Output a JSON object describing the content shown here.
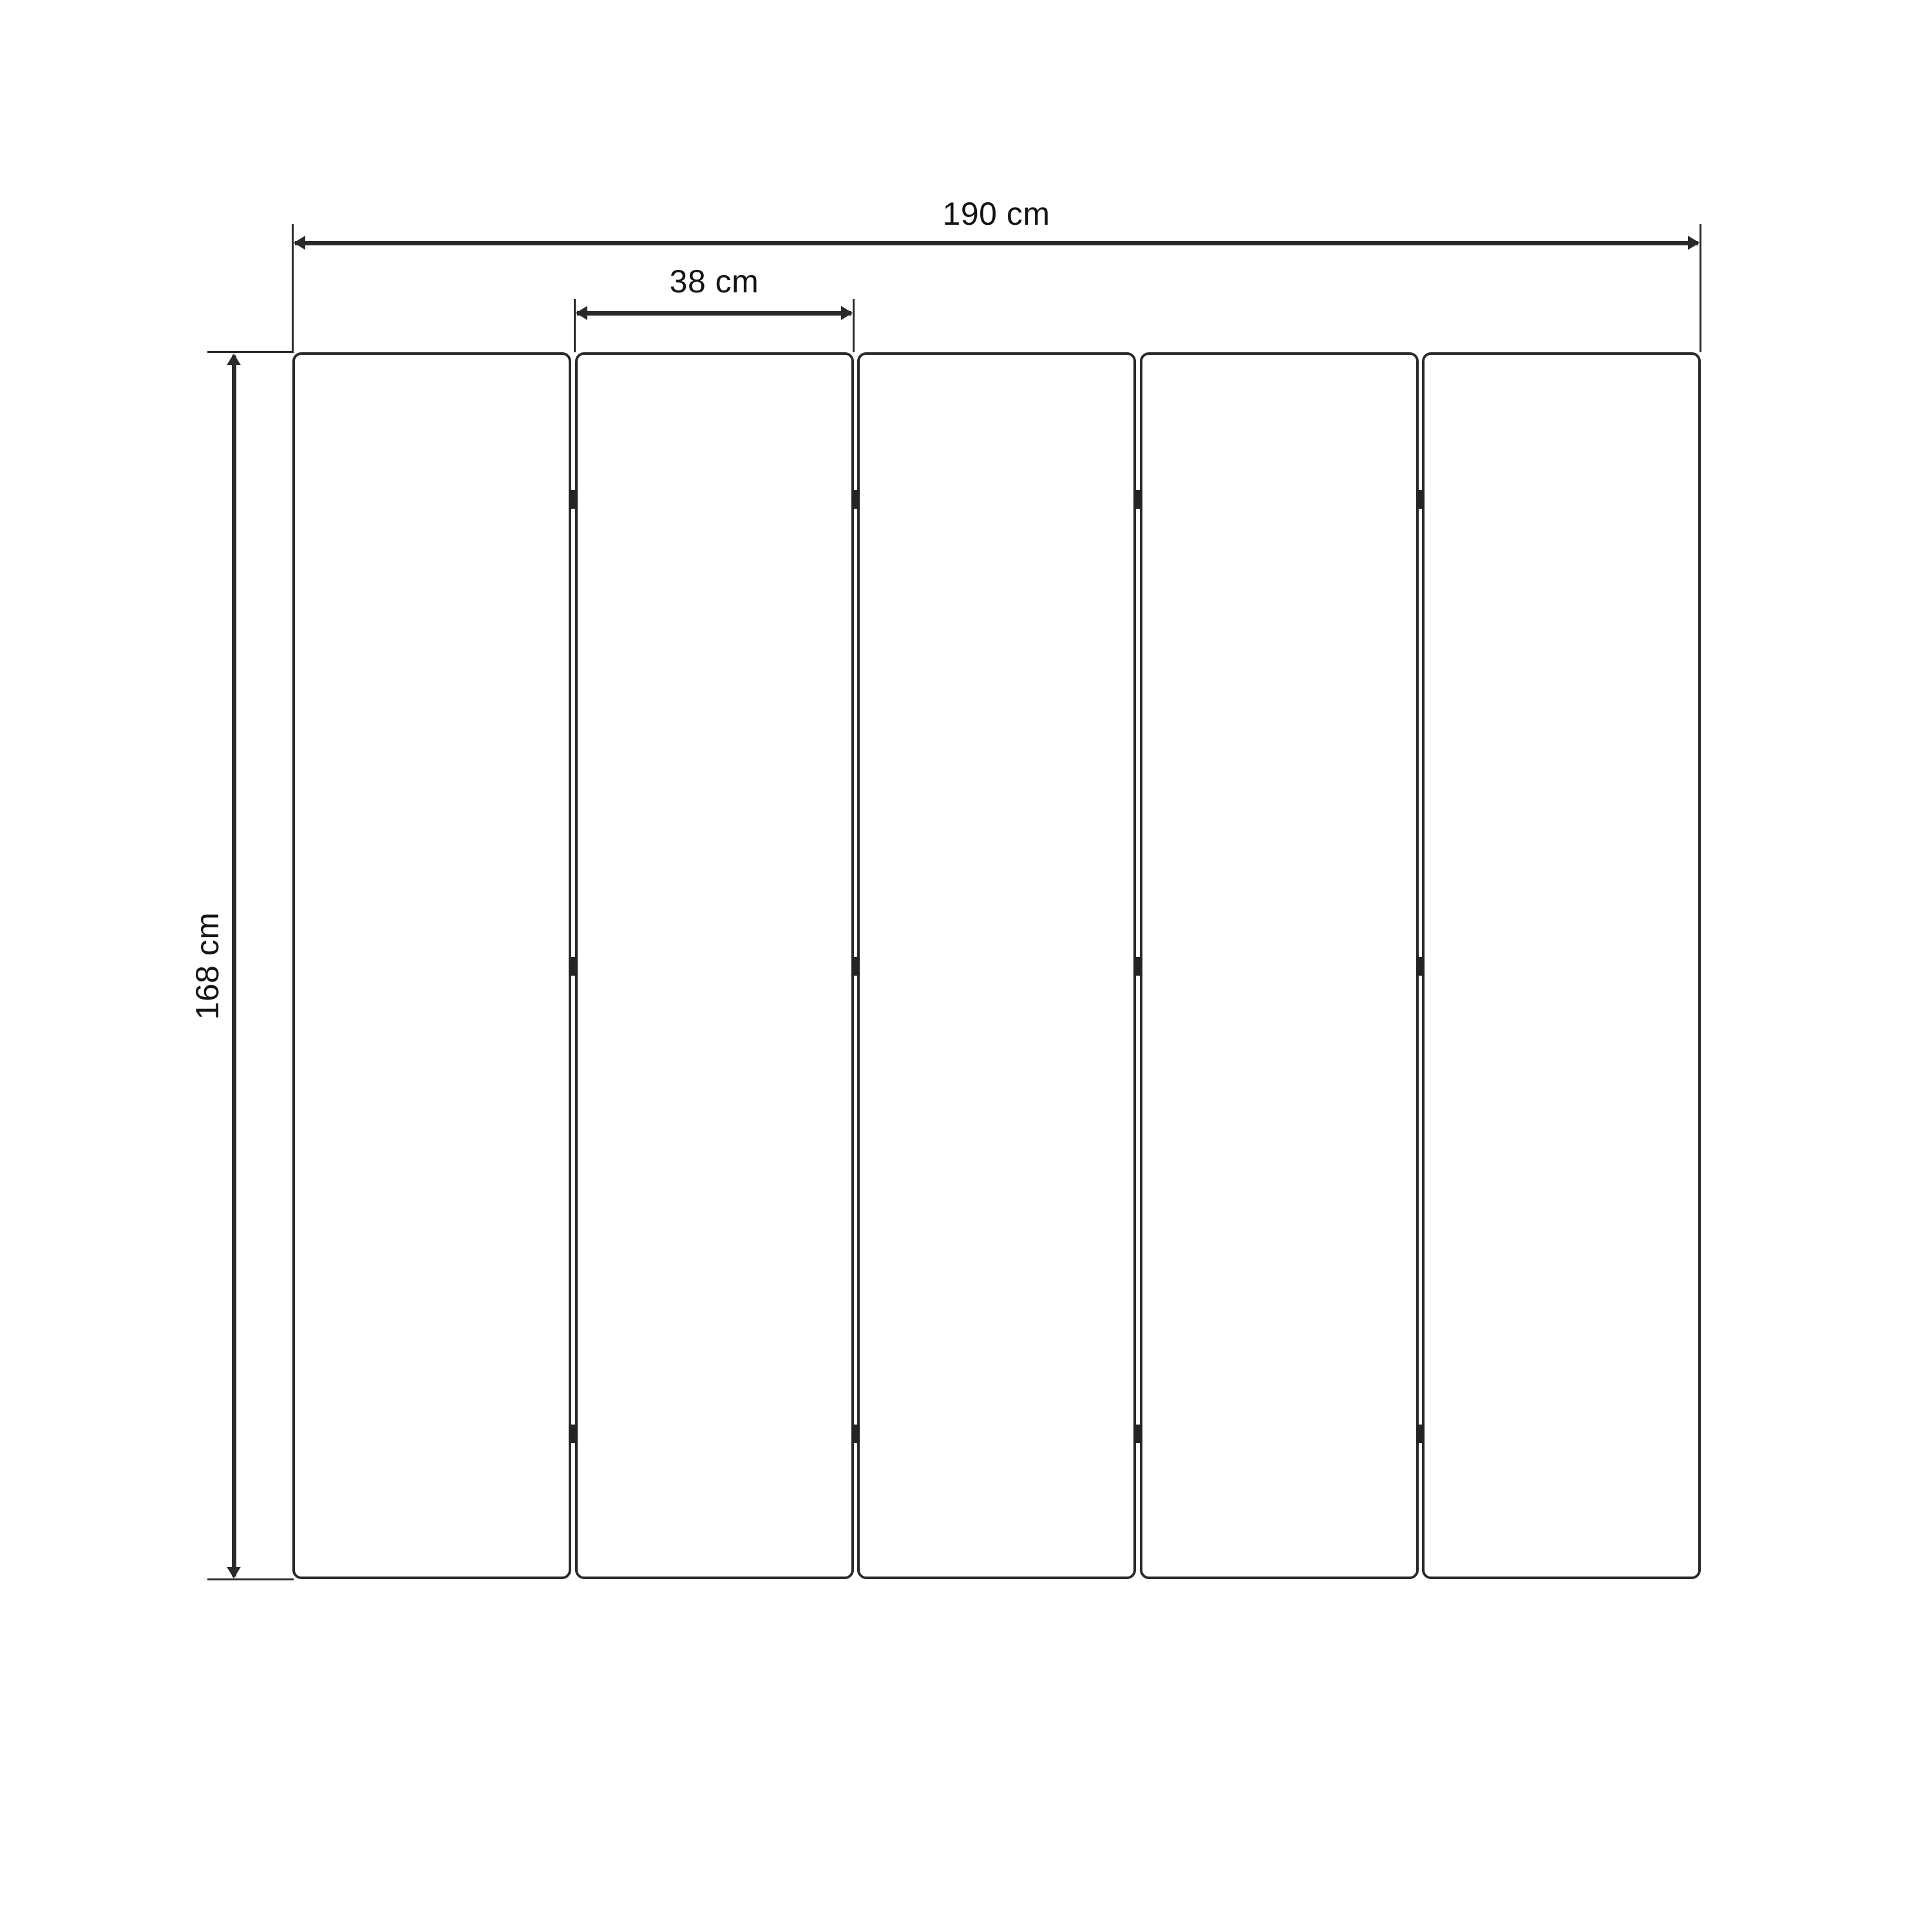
{
  "figure": {
    "type": "dimensioned-drawing",
    "subject": "five-panel folding screen (front view)",
    "panel_count": 5,
    "gap_count": 4,
    "hinges_per_gap": 3,
    "dimensions": {
      "total_width": {
        "label": "190 cm",
        "value": 190,
        "unit": "cm"
      },
      "panel_width": {
        "label": "38 cm",
        "value": 38,
        "unit": "cm"
      },
      "height": {
        "label": "168 cm",
        "value": 168,
        "unit": "cm"
      }
    },
    "colors": {
      "stroke": "#2a2a2a",
      "hinge": "#242424",
      "panel_fill": "#ffffff",
      "background": "#ffffff",
      "text": "#141414"
    }
  }
}
